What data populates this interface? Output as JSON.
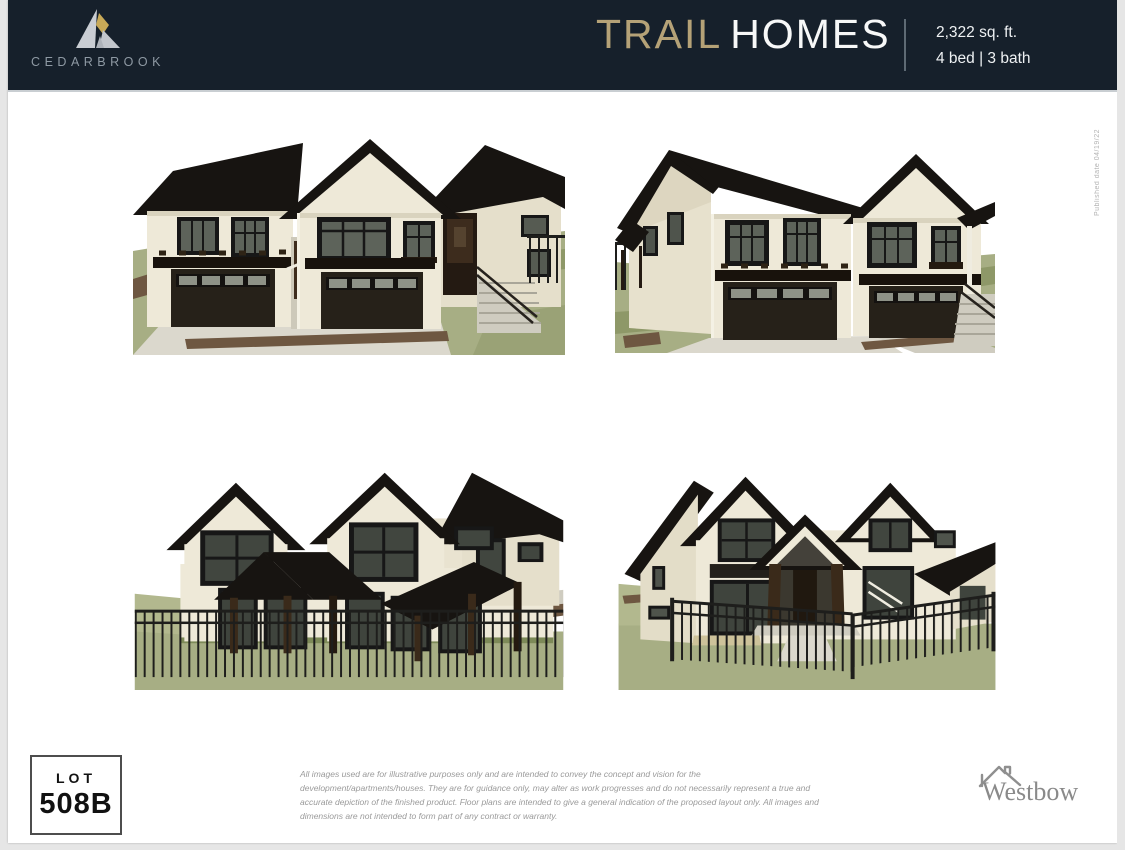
{
  "header": {
    "brand": {
      "name": "CEDARBROOK"
    },
    "title": {
      "primary": "TRAIL",
      "secondary": "HOMES"
    },
    "specs": {
      "area": "2,322 sq. ft.",
      "beds_baths": "4 bed | 3 bath"
    }
  },
  "page_note": {
    "published": "Published date 04/19/22"
  },
  "gallery": {
    "renderings": [
      {
        "name": "front-exterior-view-a",
        "position": "top-left"
      },
      {
        "name": "front-exterior-view-b",
        "position": "top-right"
      },
      {
        "name": "rear-exterior-view-a",
        "position": "bottom-left"
      },
      {
        "name": "rear-exterior-view-b",
        "position": "bottom-right"
      }
    ]
  },
  "footer": {
    "lot": {
      "label": "LOT",
      "number": "508B"
    },
    "disclaimer": "All images used are for illustrative purposes only and are intended to convey the concept and vision for the development/apartments/houses. They are for guidance only, may alter as work progresses and do not necessarily represent a true and accurate depiction of the finished product. Floor plans are intended to give a general indication of the proposed layout only. All images and dimensions are not intended to form part of any contract or warranty.",
    "builder": {
      "name": "Westbow"
    }
  },
  "palette": {
    "header_bg": "#16202b",
    "accent_gold": "#b5a277",
    "brand_text": "#8e99a3",
    "logo_gold": "#c8a957",
    "logo_silver": "#c9cdd3",
    "house_wall": "#eee9d8",
    "house_roof": "#171411",
    "lawn_green": "#a7ae84",
    "concrete": "#dbd8cd",
    "page_margin": "#e6e6e6"
  }
}
